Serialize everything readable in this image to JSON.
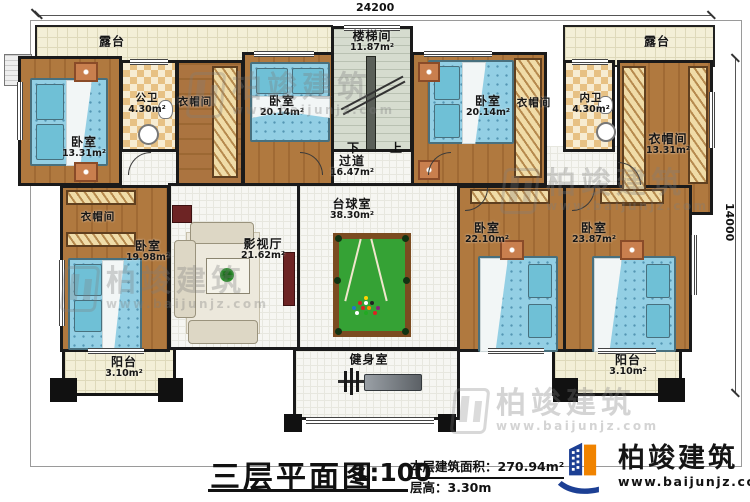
{
  "plan": {
    "title": "三层平面图",
    "scale": "1:100",
    "area_label": "本层建筑面积：",
    "area_value": "270.94m²",
    "height_label": "层高：",
    "height_value": "3.30m",
    "dim_top": "24200",
    "dim_right": "14000",
    "stair_down": "下",
    "stair_up": "上"
  },
  "brand": {
    "name": "柏竣建筑",
    "website": "www.baijunjz.com"
  },
  "watermark": {
    "name": "柏竣建筑",
    "website": "www.baijunjz.com"
  },
  "rooms": {
    "terrace_tl": {
      "name": "露台",
      "area": ""
    },
    "terrace_tr": {
      "name": "露台",
      "area": ""
    },
    "br1": {
      "name": "卧室",
      "area": "13.31m²"
    },
    "bath1": {
      "name": "公卫",
      "area": "4.30m²"
    },
    "wic_top": {
      "name": "衣帽间",
      "area": ""
    },
    "br2": {
      "name": "卧室",
      "area": "20.14m²"
    },
    "stair": {
      "name": "楼梯间",
      "area": "11.87m²"
    },
    "br3": {
      "name": "卧室",
      "area": "20.14m²"
    },
    "wic_mid": {
      "name": "衣帽间",
      "area": ""
    },
    "bath2": {
      "name": "内卫",
      "area": "4.30m²"
    },
    "wic_right": {
      "name": "衣帽间",
      "area": "13.31m²"
    },
    "corridor": {
      "name": "过道",
      "area": "16.47m²"
    },
    "wic_left": {
      "name": "衣帽间",
      "area": ""
    },
    "br_left": {
      "name": "卧室",
      "area": "19.98m²"
    },
    "theater": {
      "name": "影视厅",
      "area": "21.62m²"
    },
    "billiard": {
      "name": "台球室",
      "area": "38.30m²"
    },
    "br4": {
      "name": "卧室",
      "area": "22.10m²"
    },
    "br5": {
      "name": "卧室",
      "area": "23.87m²"
    },
    "balcony_l": {
      "name": "阳台",
      "area": "3.10m²"
    },
    "gym": {
      "name": "健身室",
      "area": ""
    },
    "balcony_r": {
      "name": "阳台",
      "area": "3.10m²"
    }
  }
}
